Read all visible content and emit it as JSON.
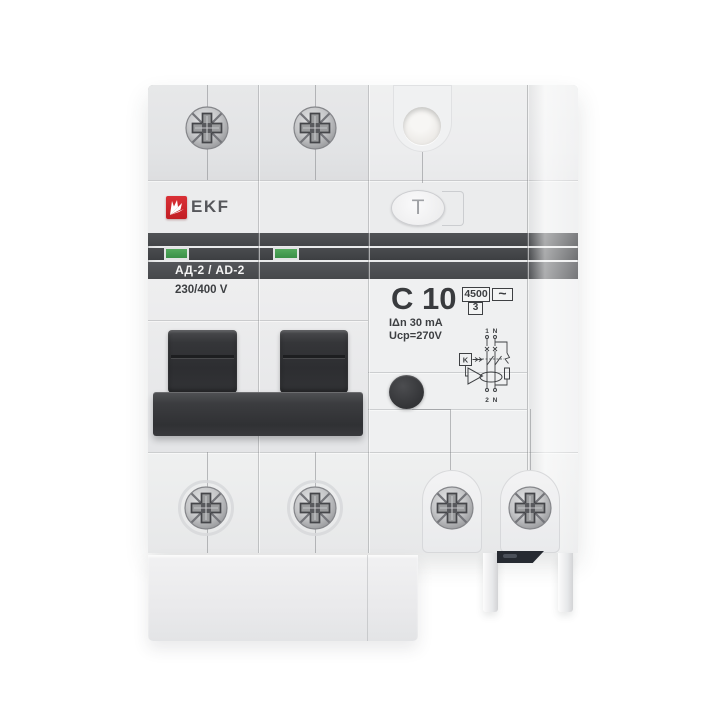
{
  "meta": {
    "description": "Product photo of a two-pole residual current circuit breaker on white background"
  },
  "device": {
    "brand": "EKF",
    "series": "АД-2 / AD-2",
    "voltage": "230/400 V",
    "rating": "C 10",
    "residual_current": "IΔn 30 mA",
    "trip_voltage": "Ucp=270V",
    "breaking_capacity": "4500",
    "energy_class": "3",
    "current_type": "~",
    "test_label": "T"
  },
  "diagram": {
    "top_terminal_1": "1",
    "top_terminal_n": "N",
    "bottom_terminal_2": "2",
    "bottom_terminal_n": "N",
    "relay": "K"
  },
  "colors": {
    "brand_red": "#cf2127",
    "indicator_green": "#3f9a4c",
    "band_dark": "#46484b",
    "handle_dark": "#323335",
    "body_gray": "#eaebec"
  }
}
